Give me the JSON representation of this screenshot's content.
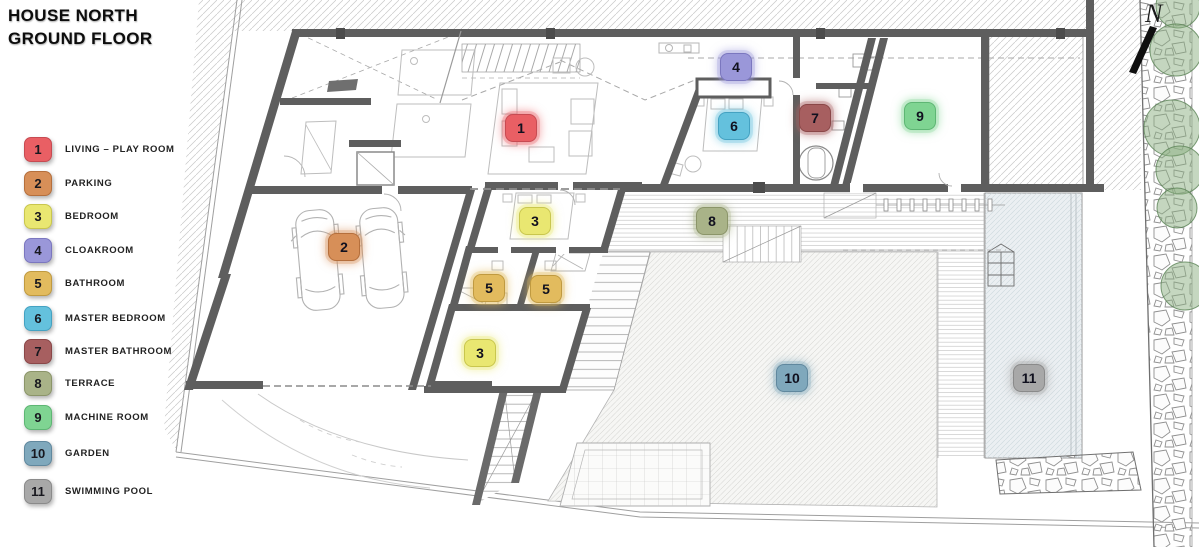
{
  "title": {
    "line1": "HOUSE NORTH",
    "line2": "GROUND FLOOR"
  },
  "north": {
    "label": "N"
  },
  "legend": {
    "items": [
      {
        "num": "1",
        "label": "LIVING – PLAY ROOM",
        "fill": "#e95f64",
        "border": "#c74b52",
        "y": 138
      },
      {
        "num": "2",
        "label": "PARKING",
        "fill": "#d78f58",
        "border": "#b56f3c",
        "y": 172
      },
      {
        "num": "3",
        "label": "BEDROOM",
        "fill": "#e9e771",
        "border": "#c9c64e",
        "y": 205
      },
      {
        "num": "4",
        "label": "CLOAKROOM",
        "fill": "#9a97d9",
        "border": "#7b77bf",
        "y": 239
      },
      {
        "num": "5",
        "label": "BATHROOM",
        "fill": "#e2bb5e",
        "border": "#c09a40",
        "y": 272
      },
      {
        "num": "6",
        "label": "MASTER BEDROOM",
        "fill": "#64c1dd",
        "border": "#44a2c2",
        "y": 307
      },
      {
        "num": "7",
        "label": "MASTER BATHROOM",
        "fill": "#a75f60",
        "border": "#8a4748",
        "y": 340
      },
      {
        "num": "8",
        "label": "TERRACE",
        "fill": "#a9b388",
        "border": "#8b9569",
        "y": 372
      },
      {
        "num": "9",
        "label": "MACHINE ROOM",
        "fill": "#7fd492",
        "border": "#5eb674",
        "y": 406
      },
      {
        "num": "10",
        "label": "GARDEN",
        "fill": "#7fa8bc",
        "border": "#60889e",
        "y": 442
      },
      {
        "num": "11",
        "label": "SWIMMING POOL",
        "fill": "#a8a8a8",
        "border": "#8a8a8a",
        "y": 480
      }
    ]
  },
  "plan_badges": [
    {
      "num": "1",
      "x": 521,
      "y": 128
    },
    {
      "num": "2",
      "x": 344,
      "y": 247
    },
    {
      "num": "3",
      "x": 535,
      "y": 221
    },
    {
      "num": "3",
      "x": 480,
      "y": 353
    },
    {
      "num": "4",
      "x": 736,
      "y": 67
    },
    {
      "num": "5",
      "x": 489,
      "y": 288
    },
    {
      "num": "5",
      "x": 546,
      "y": 289
    },
    {
      "num": "6",
      "x": 734,
      "y": 126
    },
    {
      "num": "7",
      "x": 815,
      "y": 118
    },
    {
      "num": "8",
      "x": 712,
      "y": 221
    },
    {
      "num": "9",
      "x": 920,
      "y": 116
    },
    {
      "num": "10",
      "x": 792,
      "y": 378
    },
    {
      "num": "11",
      "x": 1029,
      "y": 378
    }
  ]
}
